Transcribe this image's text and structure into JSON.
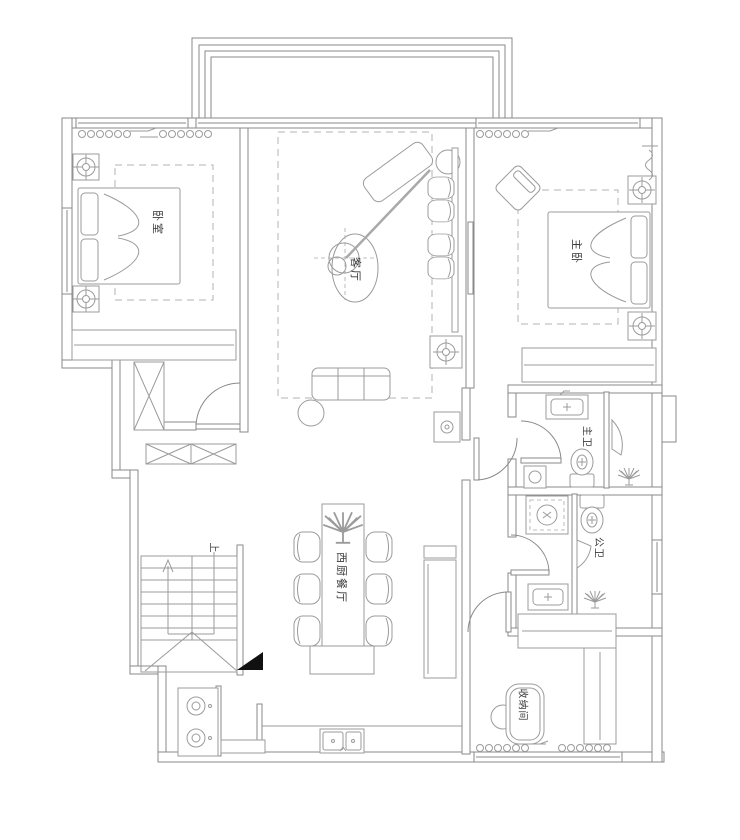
{
  "rooms": {
    "bedroom": {
      "label": "卧室"
    },
    "living": {
      "label": "客厅"
    },
    "master": {
      "label": "主卧"
    },
    "master_bath": {
      "label": "主卫"
    },
    "public_bath": {
      "label": "公卫"
    },
    "dining": {
      "label": "西厨餐厅"
    },
    "storage": {
      "label": "收纳间"
    },
    "stairs": {
      "label": "上"
    }
  },
  "colors": {
    "wall_line": "#8a8a8a",
    "furniture_line": "#9b9b9b",
    "ceiling_dash": "#b3b3b3",
    "label_text": "#3a3a3a",
    "direction_marker": "#111111",
    "background": "#ffffff"
  }
}
